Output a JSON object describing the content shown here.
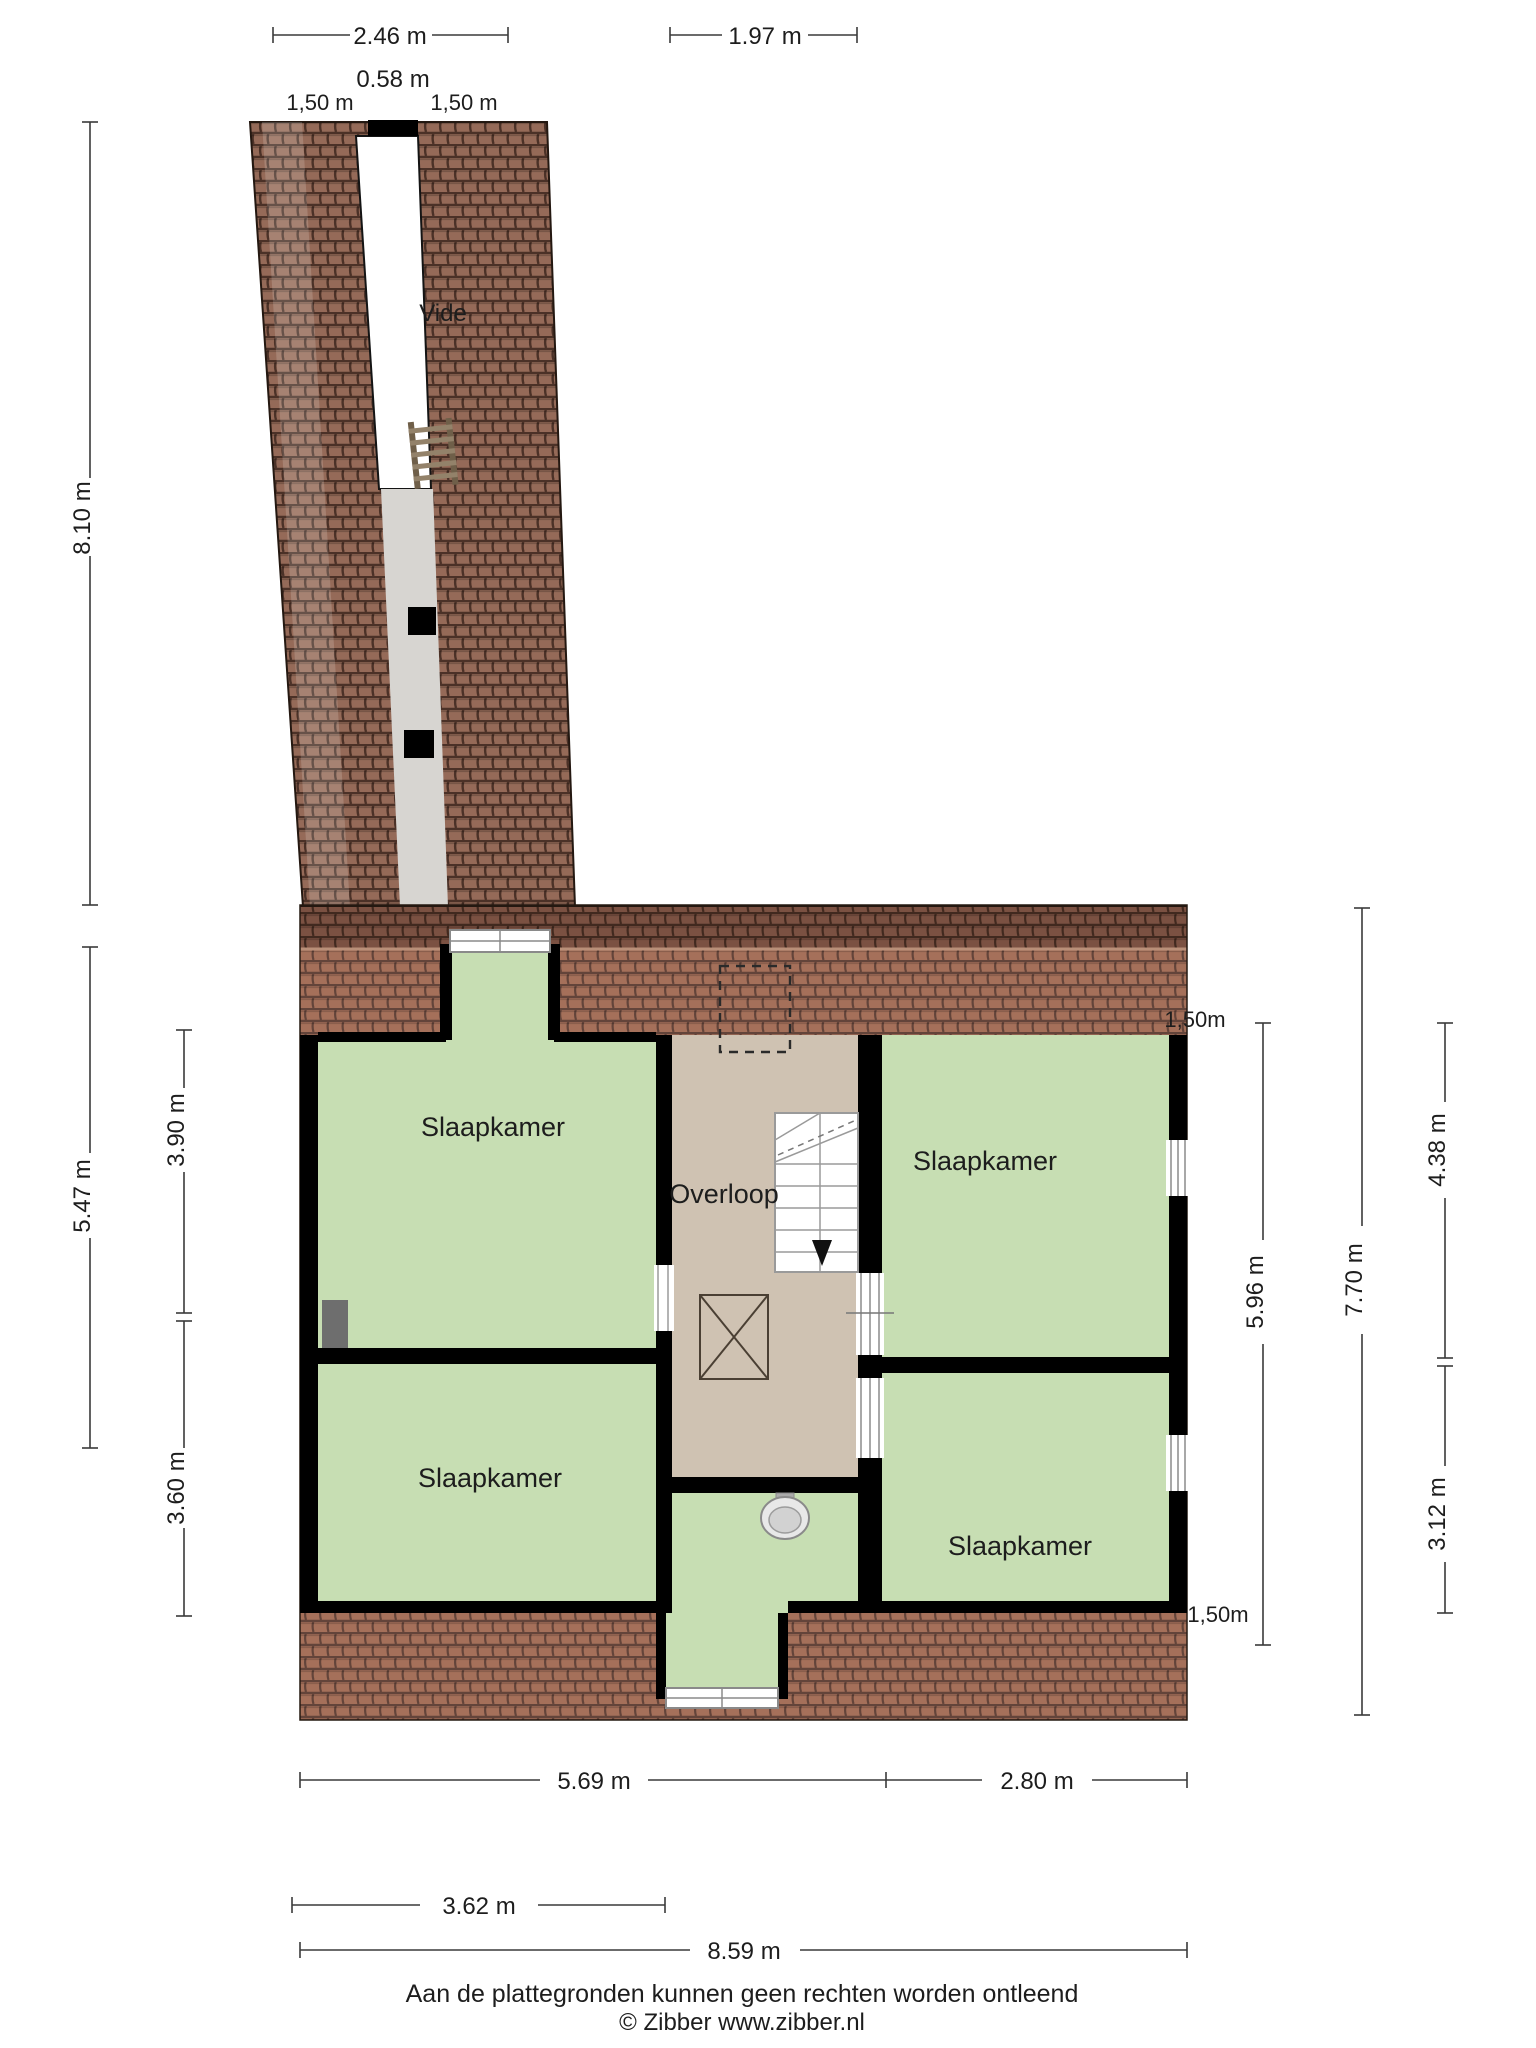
{
  "title": "Floor plan - verdieping",
  "labels": {
    "vide": "Vide",
    "overloop": "Overloop",
    "bedroom_tl": "Slaapkamer",
    "bedroom_tr": "Slaapkamer",
    "bedroom_bl": "Slaapkamer",
    "bedroom_br": "Slaapkamer"
  },
  "dims": {
    "top_width_left": "2.46 m",
    "top_width_right": "1.97 m",
    "top_vide": "0.58 m",
    "top_knee_left": "1,50 m",
    "top_knee_right": "1,50 m",
    "left_total": "8.10 m",
    "left_main": "5.47 m",
    "left_room_top": "3.90 m",
    "left_room_bottom": "3.60 m",
    "right_knee_top": "1,50m",
    "right_top": "4.38 m",
    "right_inner": "5.96 m",
    "right_total": "7.70 m",
    "right_bottom": "3.12 m",
    "right_knee_bottom": "1,50m",
    "bottom_left": "5.69 m",
    "bottom_right": "2.80 m",
    "bottom_inner": "3.62 m",
    "bottom_total": "8.59 m"
  },
  "footer": {
    "disclaimer": "Aan de plattegronden kunnen geen rechten worden ontleend",
    "credit": "© Zibber www.zibber.nl"
  },
  "colors": {
    "room_green": "#c7deb3",
    "landing_tan": "#cfc2b2",
    "corridor_grey": "#d7d5d1",
    "roof_main": "#a5705a",
    "roof_dark": "#7b5142",
    "roof_corridor": "#956a58",
    "wall": "#000000"
  }
}
